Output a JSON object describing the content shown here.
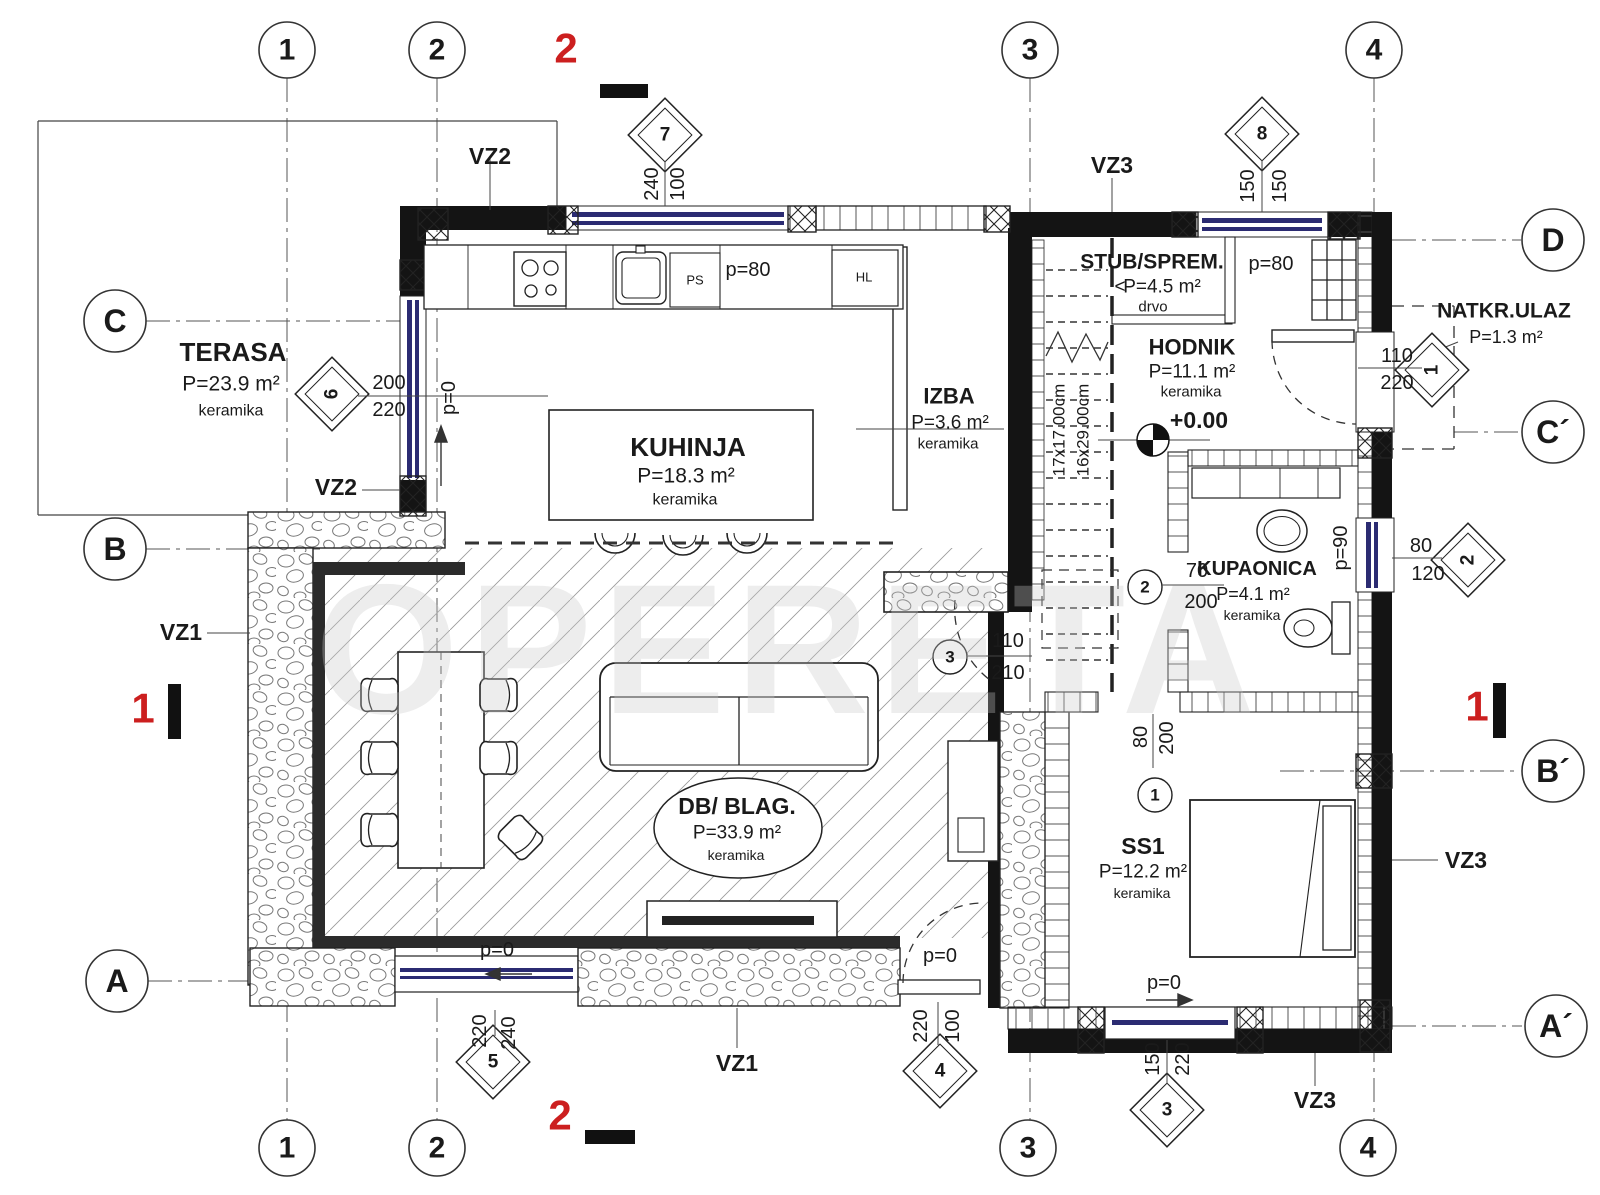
{
  "drawing": {
    "type": "floor-plan",
    "watermark": "OPERETA",
    "level_mark": "+0.00",
    "accent_red": "#cc1f1f",
    "window_blue": "#2b2b72"
  },
  "grid": {
    "columns": [
      "1",
      "2",
      "3",
      "4"
    ],
    "rows_left": [
      "C",
      "B",
      "A"
    ],
    "rows_right": [
      "D",
      "C´",
      "B´",
      "A´"
    ]
  },
  "rooms": [
    {
      "name": "TERASA",
      "area": "P=23.9 m²",
      "floor": "keramika"
    },
    {
      "name": "KUHINJA",
      "area": "P=18.3 m²",
      "floor": "keramika"
    },
    {
      "name": "IZBA",
      "area": "P=3.6 m²",
      "floor": "keramika"
    },
    {
      "name": "STUB/SPREM.",
      "area": "P=4.5 m²",
      "floor": "drvo"
    },
    {
      "name": "HODNIK",
      "area": "P=11.1 m²",
      "floor": "keramika",
      "level": "+0.00"
    },
    {
      "name": "NATKR.ULAZ",
      "area": "P=1.3 m²",
      "floor": ""
    },
    {
      "name": "KUPAONICA",
      "area": "P=4.1 m²",
      "floor": "keramika"
    },
    {
      "name": "DB/ BLAG.",
      "area": "P=33.9 m²",
      "floor": "keramika"
    },
    {
      "name": "SS1",
      "area": "P=12.2 m²",
      "floor": "keramika"
    }
  ],
  "openings": {
    "windows": [
      {
        "id": "7",
        "dims": "240/100"
      },
      {
        "id": "8",
        "dims": "150/150"
      },
      {
        "id": "6",
        "dims": "200/220"
      },
      {
        "id": "5",
        "dims": "220/240"
      },
      {
        "id": "4",
        "dims": "100/220"
      },
      {
        "id": "3",
        "dims": "150/220"
      },
      {
        "id": "2",
        "dims": "80/120"
      },
      {
        "id": "1",
        "dims": "110/220"
      }
    ],
    "doors": [
      {
        "id": "1",
        "dims": "80/200"
      },
      {
        "id": "2",
        "dims": "70/200"
      },
      {
        "id": "3",
        "dims": "110/210"
      }
    ],
    "parapets": [
      "p=80",
      "p=90",
      "p=0"
    ]
  },
  "stairs": {
    "riser": "17x17.00cm",
    "tread": "16x29.00cm"
  },
  "wall_types": [
    "VZ1",
    "VZ2",
    "VZ3"
  ],
  "section_marks": [
    "1",
    "2"
  ],
  "kitchen_units": [
    "PS",
    "HL"
  ],
  "labels": [
    {
      "n": "watermark",
      "t": "OPERETA",
      "x": 790,
      "y": 650,
      "s": 185,
      "b": 1,
      "c": "#c9c9c9",
      "o": 0.32,
      "ls": 10
    },
    {
      "n": "grid-1-top",
      "t": "1",
      "x": 287,
      "y": 50,
      "s": 30,
      "b": 1
    },
    {
      "n": "grid-2-top",
      "t": "2",
      "x": 437,
      "y": 50,
      "s": 30,
      "b": 1
    },
    {
      "n": "grid-3-top",
      "t": "3",
      "x": 1030,
      "y": 50,
      "s": 30,
      "b": 1
    },
    {
      "n": "grid-4-top",
      "t": "4",
      "x": 1374,
      "y": 50,
      "s": 30,
      "b": 1
    },
    {
      "n": "grid-1-bottom",
      "t": "1",
      "x": 287,
      "y": 1148,
      "s": 30,
      "b": 1
    },
    {
      "n": "grid-2-bottom",
      "t": "2",
      "x": 437,
      "y": 1148,
      "s": 30,
      "b": 1
    },
    {
      "n": "grid-3-bottom",
      "t": "3",
      "x": 1028,
      "y": 1148,
      "s": 30,
      "b": 1
    },
    {
      "n": "grid-4-bottom",
      "t": "4",
      "x": 1368,
      "y": 1148,
      "s": 30,
      "b": 1
    },
    {
      "n": "grid-C",
      "t": "C",
      "x": 115,
      "y": 321,
      "s": 32,
      "b": 1
    },
    {
      "n": "grid-B",
      "t": "B",
      "x": 115,
      "y": 549,
      "s": 32,
      "b": 1
    },
    {
      "n": "grid-A",
      "t": "A",
      "x": 117,
      "y": 981,
      "s": 32,
      "b": 1
    },
    {
      "n": "grid-D",
      "t": "D",
      "x": 1553,
      "y": 240,
      "s": 32,
      "b": 1
    },
    {
      "n": "grid-C-prime",
      "t": "C´",
      "x": 1553,
      "y": 432,
      "s": 32,
      "b": 1
    },
    {
      "n": "grid-B-prime",
      "t": "B´",
      "x": 1553,
      "y": 771,
      "s": 32,
      "b": 1
    },
    {
      "n": "grid-A-prime",
      "t": "A´",
      "x": 1556,
      "y": 1026,
      "s": 32,
      "b": 1
    },
    {
      "n": "section-2-top",
      "t": "2",
      "x": 566,
      "y": 48,
      "s": 42,
      "b": 1,
      "c": "#cc1f1f"
    },
    {
      "n": "section-2-bottom",
      "t": "2",
      "x": 560,
      "y": 1115,
      "s": 42,
      "b": 1,
      "c": "#cc1f1f"
    },
    {
      "n": "section-1-left",
      "t": "1",
      "x": 143,
      "y": 708,
      "s": 42,
      "b": 1,
      "c": "#cc1f1f"
    },
    {
      "n": "section-1-right",
      "t": "1",
      "x": 1477,
      "y": 706,
      "s": 42,
      "b": 1,
      "c": "#cc1f1f"
    },
    {
      "n": "diamond-7",
      "t": "7",
      "x": 665,
      "y": 135,
      "s": 19,
      "b": 1
    },
    {
      "n": "diamond-8",
      "t": "8",
      "x": 1262,
      "y": 134,
      "s": 19,
      "b": 1
    },
    {
      "n": "diamond-6",
      "t": "6",
      "x": 332,
      "y": 394,
      "s": 19,
      "b": 1,
      "r": -90
    },
    {
      "n": "diamond-5",
      "t": "5",
      "x": 493,
      "y": 1062,
      "s": 19,
      "b": 1
    },
    {
      "n": "diamond-4",
      "t": "4",
      "x": 940,
      "y": 1071,
      "s": 19,
      "b": 1
    },
    {
      "n": "diamond-3",
      "t": "3",
      "x": 1167,
      "y": 1110,
      "s": 19,
      "b": 1
    },
    {
      "n": "diamond-2",
      "t": "2",
      "x": 1468,
      "y": 560,
      "s": 19,
      "b": 1,
      "r": -90
    },
    {
      "n": "diamond-1",
      "t": "1",
      "x": 1432,
      "y": 370,
      "s": 19,
      "b": 1,
      "r": -90
    },
    {
      "n": "door-mark-2",
      "t": "2",
      "x": 1145,
      "y": 587,
      "s": 17,
      "b": 1
    },
    {
      "n": "door-mark-3",
      "t": "3",
      "x": 950,
      "y": 657,
      "s": 17,
      "b": 1
    },
    {
      "n": "door-mark-1",
      "t": "1",
      "x": 1155,
      "y": 795,
      "s": 17,
      "b": 1
    },
    {
      "n": "dim-240-w7",
      "t": "240",
      "x": 652,
      "y": 184,
      "s": 20,
      "r": -90
    },
    {
      "n": "dim-100-w7",
      "t": "100",
      "x": 678,
      "y": 184,
      "s": 20,
      "r": -90
    },
    {
      "n": "dim-150a-w8",
      "t": "150",
      "x": 1248,
      "y": 186,
      "s": 20,
      "r": -90
    },
    {
      "n": "dim-150b-w8",
      "t": "150",
      "x": 1280,
      "y": 186,
      "s": 20,
      "r": -90
    },
    {
      "n": "dim-200-w6",
      "t": "200",
      "x": 389,
      "y": 383,
      "s": 20
    },
    {
      "n": "dim-220-w6",
      "t": "220",
      "x": 389,
      "y": 410,
      "s": 20
    },
    {
      "n": "dim-220-w5",
      "t": "220",
      "x": 480,
      "y": 1031,
      "s": 20,
      "r": -90
    },
    {
      "n": "dim-240-w5",
      "t": "240",
      "x": 509,
      "y": 1033,
      "s": 20,
      "r": -90
    },
    {
      "n": "dim-220-d4",
      "t": "220",
      "x": 921,
      "y": 1026,
      "s": 20,
      "r": -90
    },
    {
      "n": "dim-100-d4",
      "t": "100",
      "x": 953,
      "y": 1026,
      "s": 20,
      "r": -90
    },
    {
      "n": "dim-150-w3",
      "t": "150",
      "x": 1153,
      "y": 1059,
      "s": 20,
      "r": -90
    },
    {
      "n": "dim-220-w3",
      "t": "220",
      "x": 1183,
      "y": 1059,
      "s": 20,
      "r": -90
    },
    {
      "n": "dim-110-w1",
      "t": "110",
      "x": 1397,
      "y": 356,
      "s": 20
    },
    {
      "n": "dim-220-w1",
      "t": "220",
      "x": 1397,
      "y": 383,
      "s": 20
    },
    {
      "n": "dim-80-w2",
      "t": "80",
      "x": 1421,
      "y": 546,
      "s": 20
    },
    {
      "n": "dim-120-w2",
      "t": "120",
      "x": 1428,
      "y": 574,
      "s": 20
    },
    {
      "n": "dim-110-d3",
      "t": "110",
      "x": 1008,
      "y": 641,
      "s": 20
    },
    {
      "n": "dim-210-d3",
      "t": "210",
      "x": 1008,
      "y": 673,
      "s": 20
    },
    {
      "n": "dim-70-d2",
      "t": "70",
      "x": 1197,
      "y": 571,
      "s": 20
    },
    {
      "n": "dim-200-d2",
      "t": "200",
      "x": 1201,
      "y": 602,
      "s": 20
    },
    {
      "n": "dim-80-d1",
      "t": "80",
      "x": 1141,
      "y": 737,
      "s": 20,
      "r": -90
    },
    {
      "n": "dim-200-d1",
      "t": "200",
      "x": 1167,
      "y": 738,
      "s": 20,
      "r": -90
    },
    {
      "n": "stairs-riser",
      "t": "17x17.00cm",
      "x": 1059,
      "y": 430,
      "s": 17,
      "r": -90
    },
    {
      "n": "stairs-tread",
      "t": "16x29.00cm",
      "x": 1083,
      "y": 430,
      "s": 17,
      "r": -90
    },
    {
      "n": "parapet-kitchen",
      "t": "p=80",
      "x": 748,
      "y": 270,
      "s": 20
    },
    {
      "n": "parapet-hall",
      "t": "p=80",
      "x": 1271,
      "y": 264,
      "s": 20
    },
    {
      "n": "parapet-bath",
      "t": "p=90",
      "x": 1341,
      "y": 548,
      "s": 20,
      "r": -90
    },
    {
      "n": "parapet-kwin",
      "t": "p=0",
      "x": 449,
      "y": 398,
      "s": 20,
      "r": -90
    },
    {
      "n": "parapet-sw",
      "t": "p=0",
      "x": 497,
      "y": 950,
      "s": 20
    },
    {
      "n": "parapet-door",
      "t": "p=0",
      "x": 940,
      "y": 956,
      "s": 20
    },
    {
      "n": "parapet-ss1",
      "t": "p=0",
      "x": 1164,
      "y": 983,
      "s": 20
    },
    {
      "n": "vz2-top",
      "t": "VZ2",
      "x": 490,
      "y": 156,
      "s": 23,
      "b": 1
    },
    {
      "n": "vz2-left",
      "t": "VZ2",
      "x": 336,
      "y": 487,
      "s": 23,
      "b": 1
    },
    {
      "n": "vz1-left",
      "t": "VZ1",
      "x": 181,
      "y": 632,
      "s": 23,
      "b": 1
    },
    {
      "n": "vz1-bottom",
      "t": "VZ1",
      "x": 737,
      "y": 1063,
      "s": 23,
      "b": 1
    },
    {
      "n": "vz3-top",
      "t": "VZ3",
      "x": 1112,
      "y": 165,
      "s": 23,
      "b": 1
    },
    {
      "n": "vz3-right",
      "t": "VZ3",
      "x": 1466,
      "y": 860,
      "s": 23,
      "b": 1
    },
    {
      "n": "vz3-bottom",
      "t": "VZ3",
      "x": 1315,
      "y": 1100,
      "s": 23,
      "b": 1
    },
    {
      "n": "terasa-title",
      "t": "TERASA",
      "x": 233,
      "y": 352,
      "s": 26,
      "b": 1
    },
    {
      "n": "terasa-area",
      "t": "P=23.9 m²",
      "x": 231,
      "y": 384,
      "s": 21
    },
    {
      "n": "terasa-floor",
      "t": "keramika",
      "x": 231,
      "y": 411,
      "s": 16
    },
    {
      "n": "kuhinja-title",
      "t": "KUHINJA",
      "x": 688,
      "y": 447,
      "s": 26,
      "b": 1
    },
    {
      "n": "kuhinja-area",
      "t": "P=18.3 m²",
      "x": 686,
      "y": 476,
      "s": 21
    },
    {
      "n": "kuhinja-floor",
      "t": "keramika",
      "x": 685,
      "y": 500,
      "s": 16
    },
    {
      "n": "izba-title",
      "t": "IZBA",
      "x": 949,
      "y": 396,
      "s": 22,
      "b": 1
    },
    {
      "n": "izba-area",
      "t": "P=3.6 m²",
      "x": 950,
      "y": 423,
      "s": 19
    },
    {
      "n": "izba-floor",
      "t": "keramika",
      "x": 948,
      "y": 444,
      "s": 15
    },
    {
      "n": "stub-title",
      "t": "STUB/SPREM.",
      "x": 1152,
      "y": 262,
      "s": 21,
      "b": 1
    },
    {
      "n": "stub-arrow",
      "t": "<",
      "x": 1120,
      "y": 287,
      "s": 19
    },
    {
      "n": "stub-area",
      "t": "P=4.5 m²",
      "x": 1162,
      "y": 287,
      "s": 19
    },
    {
      "n": "stub-floor",
      "t": "drvo",
      "x": 1153,
      "y": 307,
      "s": 15
    },
    {
      "n": "hodnik-title",
      "t": "HODNIK",
      "x": 1192,
      "y": 347,
      "s": 22,
      "b": 1
    },
    {
      "n": "hodnik-area",
      "t": "P=11.1 m²",
      "x": 1192,
      "y": 372,
      "s": 19
    },
    {
      "n": "hodnik-floor",
      "t": "keramika",
      "x": 1191,
      "y": 392,
      "s": 15
    },
    {
      "n": "hodnik-level",
      "t": "+0.00",
      "x": 1199,
      "y": 420,
      "s": 23,
      "b": 1
    },
    {
      "n": "natkr-title",
      "t": "NATKR.ULAZ",
      "x": 1504,
      "y": 311,
      "s": 21,
      "b": 1
    },
    {
      "n": "natkr-area",
      "t": "P=1.3 m²",
      "x": 1506,
      "y": 337,
      "s": 18
    },
    {
      "n": "kupaonica-title",
      "t": "KUPAONICA",
      "x": 1257,
      "y": 569,
      "s": 20,
      "b": 1
    },
    {
      "n": "kupaonica-area",
      "t": "P=4.1 m²",
      "x": 1253,
      "y": 594,
      "s": 18
    },
    {
      "n": "kupaonica-floor",
      "t": "keramika",
      "x": 1252,
      "y": 615,
      "s": 14
    },
    {
      "n": "db-title",
      "t": "DB/ BLAG.",
      "x": 737,
      "y": 806,
      "s": 23,
      "b": 1
    },
    {
      "n": "db-area",
      "t": "P=33.9 m²",
      "x": 737,
      "y": 833,
      "s": 19
    },
    {
      "n": "db-floor",
      "t": "keramika",
      "x": 736,
      "y": 855,
      "s": 14
    },
    {
      "n": "ss1-title",
      "t": "SS1",
      "x": 1143,
      "y": 846,
      "s": 23,
      "b": 1
    },
    {
      "n": "ss1-area",
      "t": "P=12.2 m²",
      "x": 1143,
      "y": 872,
      "s": 19
    },
    {
      "n": "ss1-floor",
      "t": "keramika",
      "x": 1142,
      "y": 893,
      "s": 14
    },
    {
      "n": "unit-ps",
      "t": "PS",
      "x": 695,
      "y": 280,
      "s": 13
    },
    {
      "n": "unit-hl",
      "t": "HL",
      "x": 864,
      "y": 277,
      "s": 13
    }
  ]
}
